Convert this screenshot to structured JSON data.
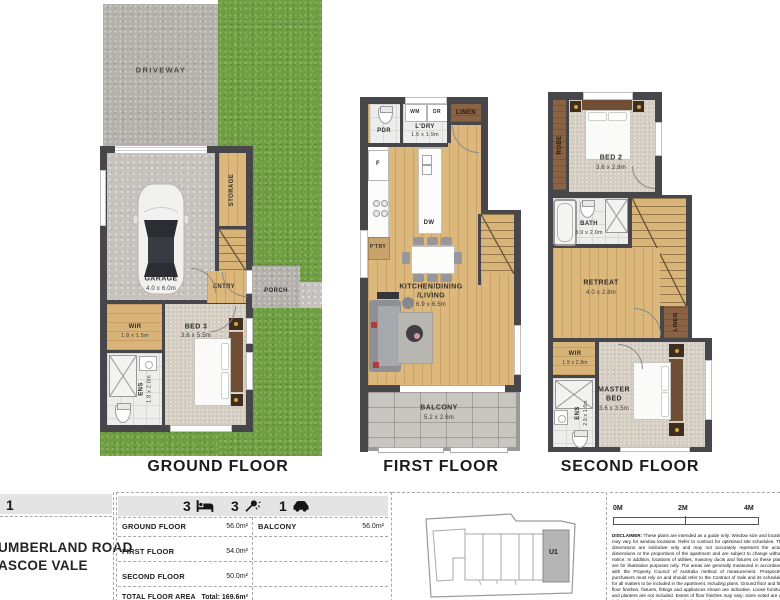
{
  "plans": {
    "ground": {
      "title": "GROUND FLOOR",
      "labels": {
        "driveway": "DRIVEWAY",
        "storage": "STORAGE",
        "garage_name": "GARAGE",
        "garage_dims": "4.0 x 6.0m",
        "entry": "ENTRY",
        "porch": "PORCH",
        "wir_name": "WIR",
        "wir_dims": "1.8 x 1.5m",
        "ens_name": "ENS",
        "ens_dims": "1.8 x 2.0m",
        "bed3_name": "BED 3",
        "bed3_dims": "3.6 x 5.5m"
      }
    },
    "first": {
      "title": "FIRST FLOOR",
      "labels": {
        "pdr": "PDR",
        "wm": "WM",
        "dr": "DR",
        "linen": "LINEN",
        "ldry_name": "L'DRY",
        "ldry_dims": "1.6 x 1.9m",
        "fridge": "F",
        "pantry": "P'TRY",
        "dw": "DW",
        "kdl_line1": "KITCHEN/DINING",
        "kdl_line2": "/LIVING",
        "kdl_dims": "6.9 x 6.5m",
        "balcony_name": "BALCONY",
        "balcony_dims": "5.2 x 2.6m"
      }
    },
    "second": {
      "title": "SECOND FLOOR",
      "labels": {
        "robe": "ROBE",
        "bed2_name": "BED 2",
        "bed2_dims": "3.6 x 2.8m",
        "bath_name": "BATH",
        "bath_dims": "3.9 x 2.0m",
        "retreat_name": "RETREAT",
        "retreat_dims": "4.0 x 2.8m",
        "linen": "LINEN",
        "wir_name": "WIR",
        "wir_dims": "1.9 x 2.8m",
        "ens_name": "ENS",
        "ens_dims": "2.9 x 1.6m",
        "master_line1": "MASTER",
        "master_line2": "BED",
        "master_dims": "3.6 x 3.5m"
      }
    }
  },
  "info": {
    "unit_number": "1",
    "address_line1": "UMBERLAND ROAD",
    "address_line2": "ASCOE VALE",
    "stats": [
      {
        "value": "3",
        "icon": "bed-icon"
      },
      {
        "value": "3",
        "icon": "shower-icon"
      },
      {
        "value": "1",
        "icon": "car-icon"
      }
    ],
    "areas": {
      "rows": [
        {
          "label": "GROUND FLOOR",
          "value": "56.0m²"
        },
        {
          "label": "FIRST FLOOR",
          "value": "54.0m²"
        },
        {
          "label": "SECOND FLOOR",
          "value": "50.0m²"
        }
      ],
      "total_label": "TOTAL FLOOR AREA",
      "total_value": "Total: 169.6m²",
      "balcony_label": "BALCONY",
      "balcony_value": "56.0m²"
    },
    "keyplan": {
      "unit_label": "U1"
    },
    "scalebar": {
      "label_0": "0M",
      "label_2": "2M",
      "label_4": "4M"
    },
    "disclaimer_label": "DISCLAIMER:",
    "disclaimer_text": "These plans are intended as a guide only. Window size and location may vary for window locations. Refer to contract for optimised site schedules. The dimensions are indicative only and may not accurately represent the actual dimensions or the proportions of the apartment and are subject to change without notice. In addition, locations of utilities, masonry ducts and fixtures on these plans are for illustrative purposes only. The areas are generally measured in accordance with the Property Council of Australia method of measurement. Prospective purchasers must rely on and should refer to the Contract of Sale and its schedules for all matters to be included in the apartment, including plans. Ground floor and first floor finishes, fixtures, fittings and appliances shown are indicative. Loose furniture and planters are not included. Extent of floor finishes may vary; sizes noted are an indication only. Refer to level plans for further information."
  }
}
